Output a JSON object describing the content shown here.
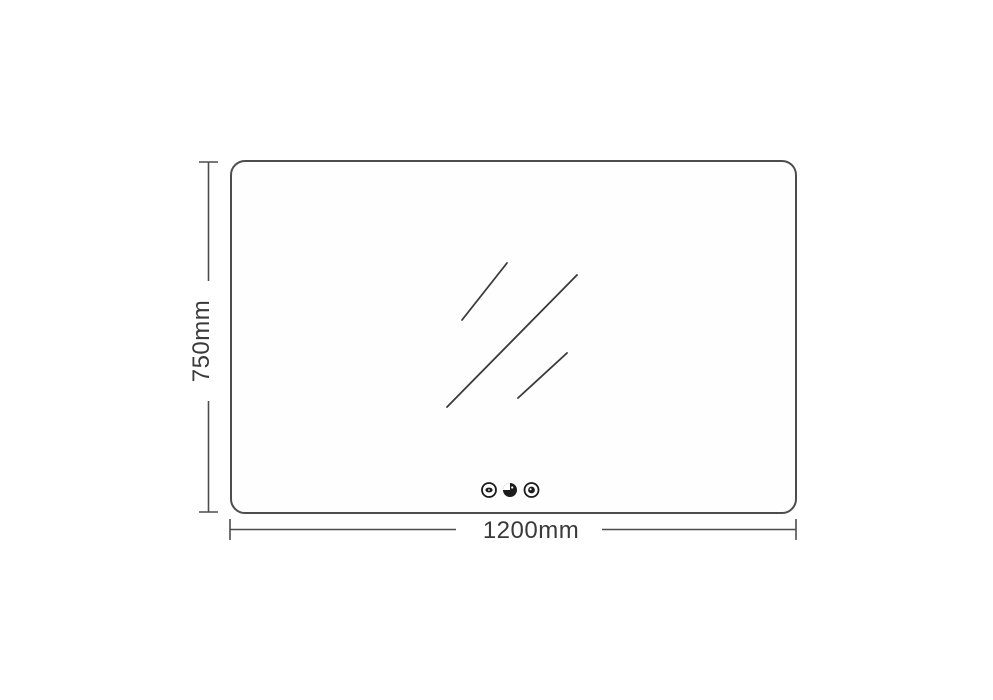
{
  "colors": {
    "background": "#ffffff",
    "line": "#4d4d4d",
    "text": "#3a3a3a",
    "icon": "#1c1c1c"
  },
  "dimensions": {
    "width": {
      "label": "1200mm"
    },
    "height": {
      "label": "750mm"
    }
  },
  "mirror": {
    "touch_buttons": [
      {
        "name": "defogger-icon"
      },
      {
        "name": "brightness-icon"
      },
      {
        "name": "power-icon"
      }
    ]
  }
}
